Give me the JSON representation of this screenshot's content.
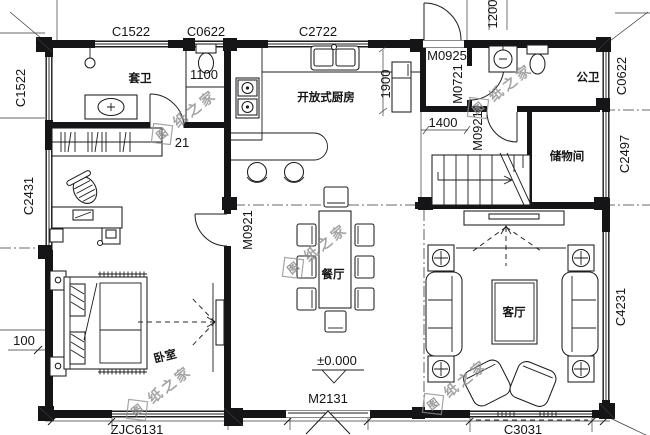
{
  "plan": {
    "rooms": {
      "ensuite": "套卫",
      "public_bath": "公卫",
      "kitchen": "开放式厨房",
      "storage": "储物间",
      "dining": "餐厅",
      "living": "客厅",
      "bedroom": "卧室"
    },
    "windows": {
      "c1522_top": "C1522",
      "c0622_top": "C0622",
      "c2722_top": "C2722",
      "c1522_left": "C1522",
      "c2431_left": "C2431",
      "c0622_right": "C0622",
      "c2497_right": "C2497",
      "c4231_right": "C4231",
      "zjc6131_bottom": "ZJC6131",
      "c3031_bottom": "C3031"
    },
    "doors": {
      "m0925_rear": "M0925",
      "m0721_bath": "M0721",
      "m0921_hall": "M0921",
      "m0921_bedroom": "M0921",
      "m2131_entrance": "M2131"
    },
    "dims": {
      "d1100": "1100",
      "d1200": "1200",
      "d1900": "1900",
      "d1400": "1400",
      "d100": "100",
      "d21": "21"
    },
    "elevation": "±0.000",
    "watermark": {
      "logo": "图",
      "tail": "纸之家"
    },
    "line_color": "#1d1d1f",
    "watermark_color": "#8e8e90"
  }
}
